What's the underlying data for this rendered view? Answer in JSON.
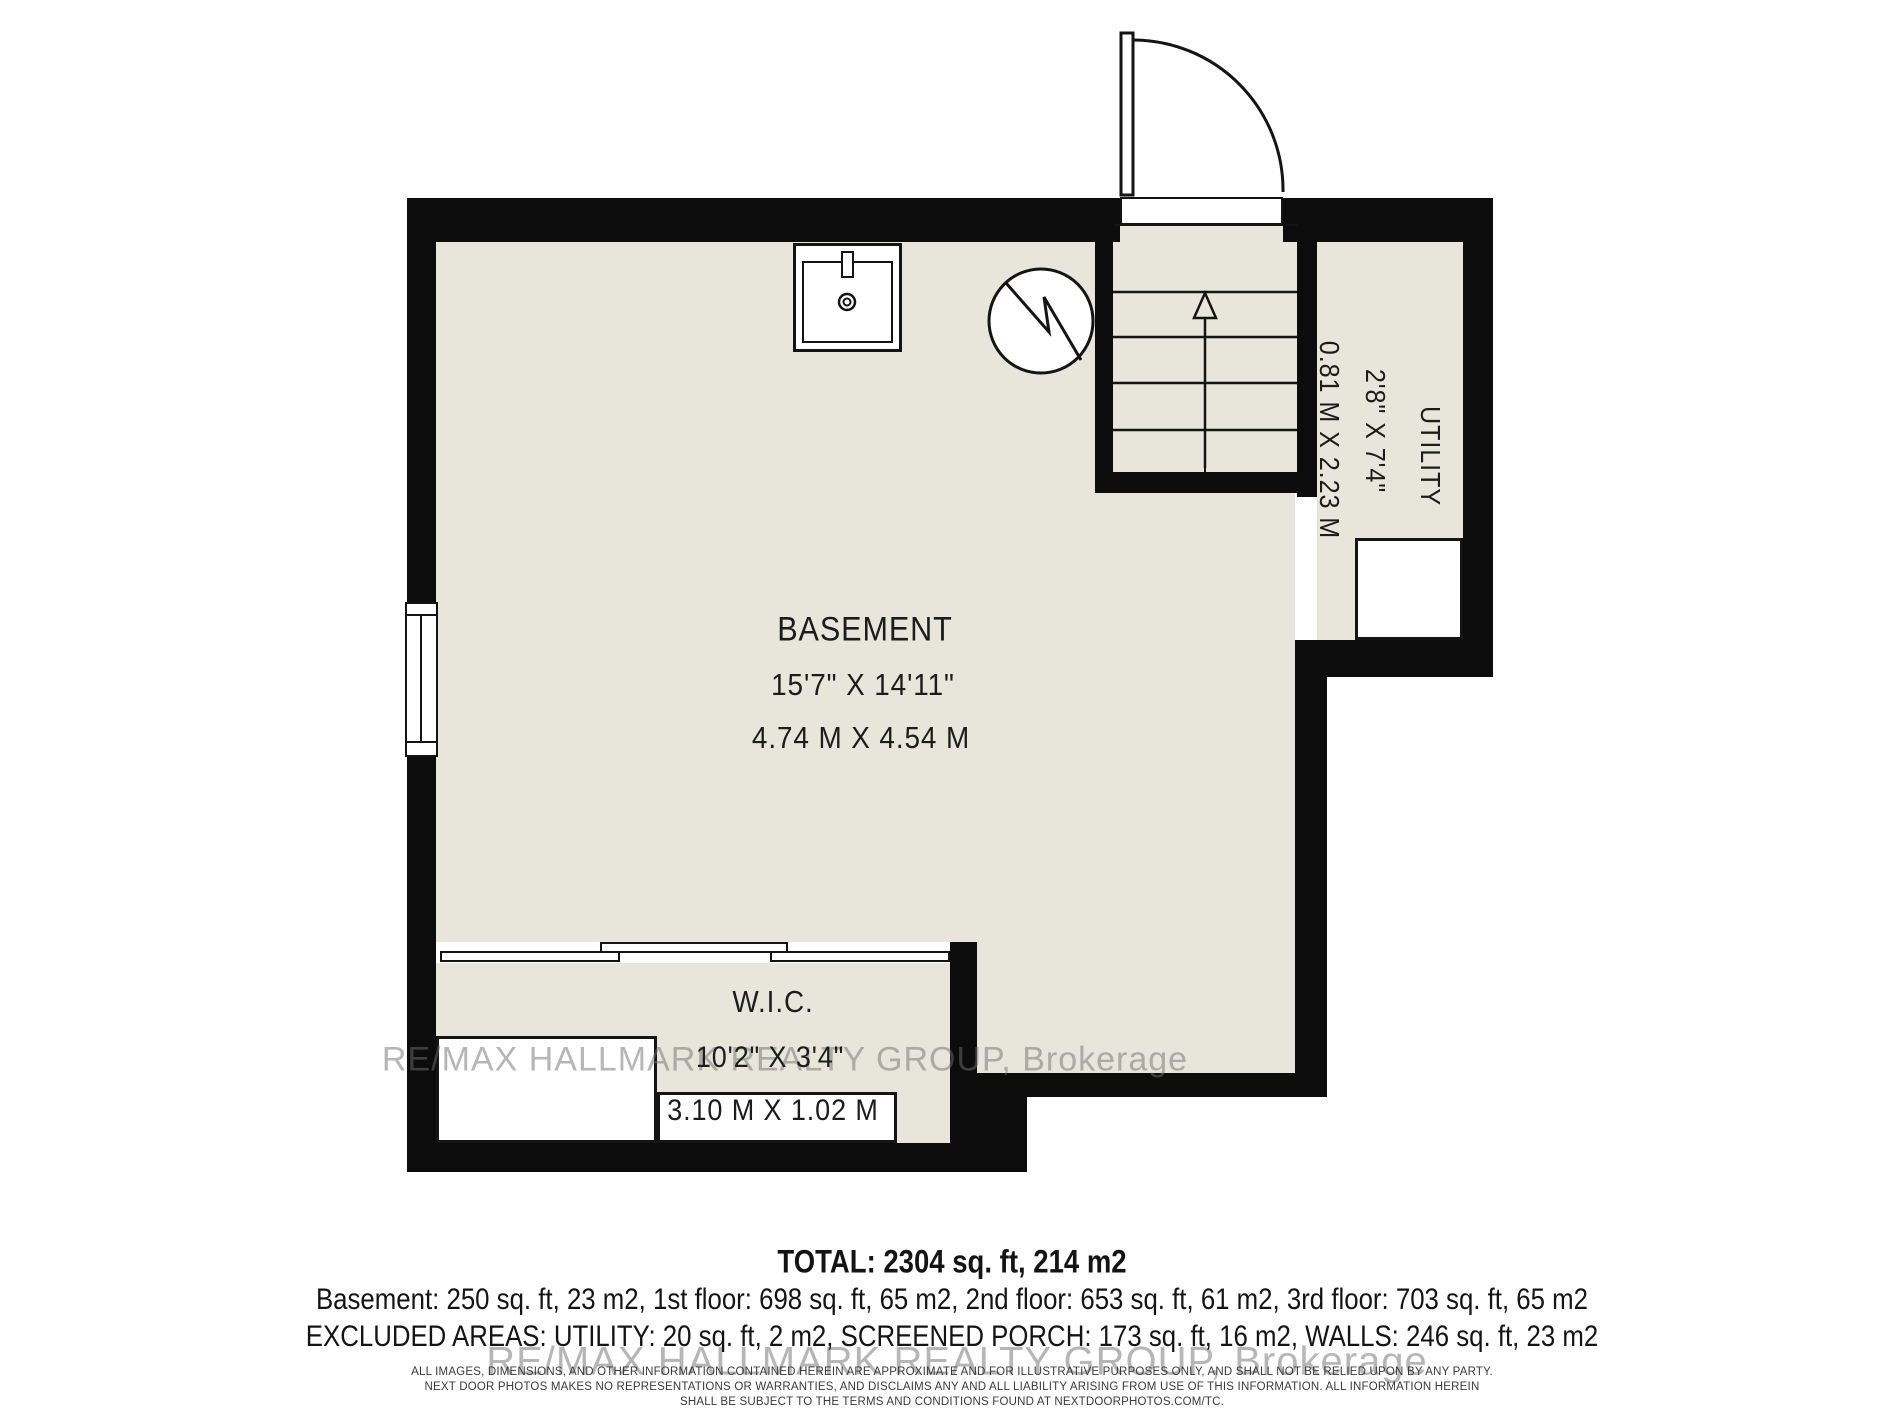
{
  "palette": {
    "floor_fill": "#e8e6da",
    "wall_color": "#0c0c0c",
    "line_color": "#141414",
    "background": "#ffffff",
    "watermark_color": "rgba(110,110,110,0.5)"
  },
  "rooms": {
    "basement": {
      "name": "BASEMENT",
      "imperial": "15'7\" X 14'11\"",
      "metric": "4.74 M X 4.54 M"
    },
    "wic": {
      "name": "W.I.C.",
      "imperial": "10'2\" X 3'4\"",
      "metric": "3.10 M X 1.02 M"
    },
    "utility": {
      "name": "UTILITY",
      "imperial": "2'8\" X 7'4\"",
      "metric": "0.81 M X 2.23 M"
    }
  },
  "symbols": {
    "stairs_direction_arrow": "up-arrow",
    "door_swing": "quarter-arc",
    "sink": "sink-with-faucet-and-drain",
    "water_heater": "circle-with-zigzag",
    "window": "left-wall-window",
    "sliding_door": "three-panel-bypass"
  },
  "summary": {
    "total": "TOTAL: 2304 sq. ft, 214 m2",
    "floors": "Basement: 250 sq. ft, 23 m2, 1st floor: 698 sq. ft, 65 m2, 2nd floor: 653 sq. ft, 61 m2, 3rd floor: 703 sq. ft, 65 m2",
    "excluded": "EXCLUDED AREAS: UTILITY: 20 sq. ft, 2 m2, SCREENED PORCH: 173 sq. ft, 16 m2, WALLS: 246 sq. ft, 23 m2"
  },
  "watermark": {
    "line1": "RE/MAX HALLMARK REALTY GROUP, Brokerage",
    "line2": "RE/MAX HALLMARK REALTY GROUP, Brokerage"
  },
  "disclaimer": {
    "line1": "ALL IMAGES, DIMENSIONS, AND OTHER INFORMATION CONTAINED HEREIN ARE APPROXIMATE AND FOR ILLUSTRATIVE PURPOSES ONLY, AND SHALL NOT BE RELIED UPON BY ANY PARTY.",
    "line2": "NEXT DOOR PHOTOS MAKES NO REPRESENTATIONS OR WARRANTIES, AND DISCLAIMS ANY AND ALL LIABILITY ARISING FROM USE OF THIS INFORMATION. ALL INFORMATION HEREIN",
    "line3": "SHALL BE SUBJECT TO THE TERMS AND CONDITIONS FOUND AT NEXTDOORPHOTOS.COM/TC."
  }
}
